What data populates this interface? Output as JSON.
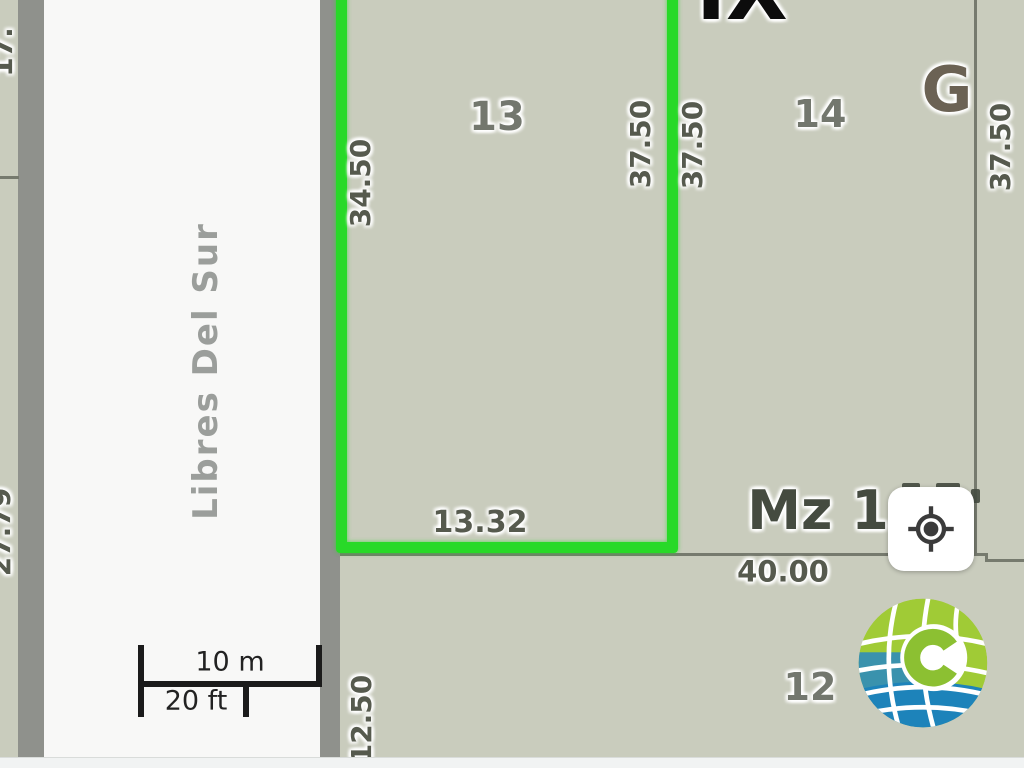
{
  "map": {
    "street_name": "Libres Del Sur",
    "zone_label": "IX",
    "sector_label": "G",
    "block_label": "Mz 1",
    "lots": {
      "selected_number": "13",
      "right_number": "14",
      "bottom_number": "12"
    },
    "dimensions": {
      "selected_left": "34.50",
      "selected_right": "37.50",
      "selected_bottom": "13.32",
      "neighbor_left": "37.50",
      "far_right": "37.50",
      "block_bottom": "40.00",
      "bottom_lot_left": "12.50",
      "street_top_partial": "17.",
      "street_bottom_partial": "27.79"
    }
  },
  "scale_bar": {
    "metric": "10 m",
    "imperial": "20 ft"
  },
  "controls": {
    "locate_button": "gps-locate"
  },
  "branding": {
    "logo": "globe-c-logo"
  },
  "colors": {
    "highlight_green": "#28d928",
    "parcel_fill": "#c9ccbd",
    "street_fill": "#f8f8f7",
    "street_border": "#8f918c",
    "boundary_line": "#767a6e",
    "lot_label_gray": "#73776e",
    "dimension_text": "#565a4e",
    "logo_green": "#a0cb36",
    "logo_blue": "#1d83ba"
  }
}
